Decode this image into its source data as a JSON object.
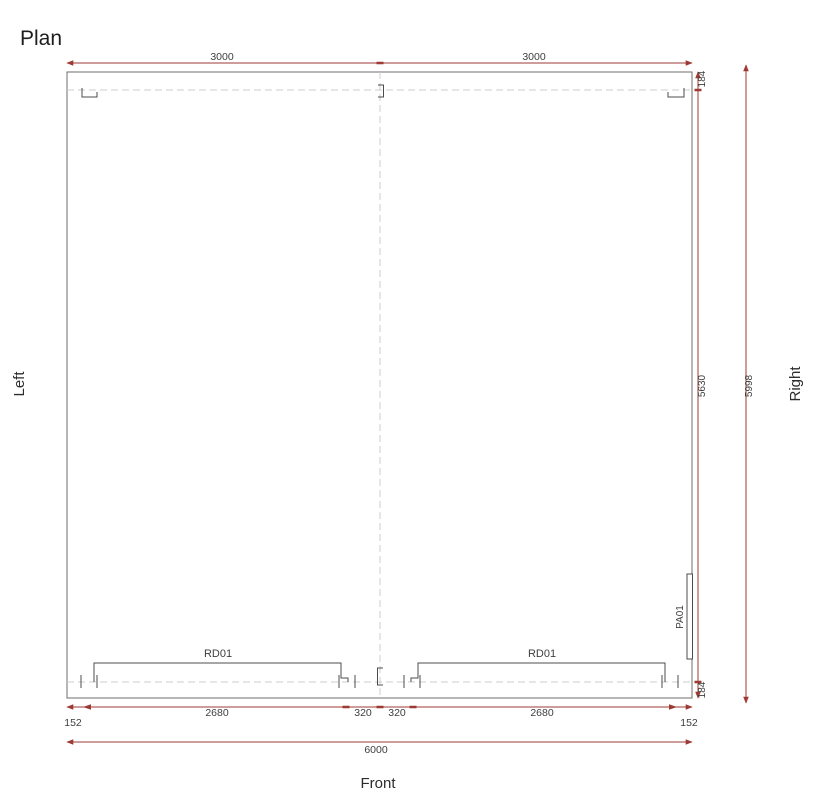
{
  "title": "Plan",
  "view_labels": {
    "left": "Left",
    "right": "Right",
    "front": "Front"
  },
  "components": {
    "roller_doors": [
      "RD01",
      "RD01"
    ],
    "panel": "PA01"
  },
  "dims": {
    "top": [
      "3000",
      "3000"
    ],
    "bottom": [
      "152",
      "2680",
      "320",
      "320",
      "2680",
      "152"
    ],
    "bottom_total": "6000",
    "right": [
      "184",
      "5630",
      "184"
    ],
    "right_total": "5998"
  },
  "colors": {
    "dimension_line": "#9c3a33",
    "drawing_line": "#6e6e6e",
    "detail_line": "#4c4c4c",
    "center_line": "#cccccc",
    "dim_text": "#3e3e3e",
    "title_text": "#1d1d1d"
  }
}
